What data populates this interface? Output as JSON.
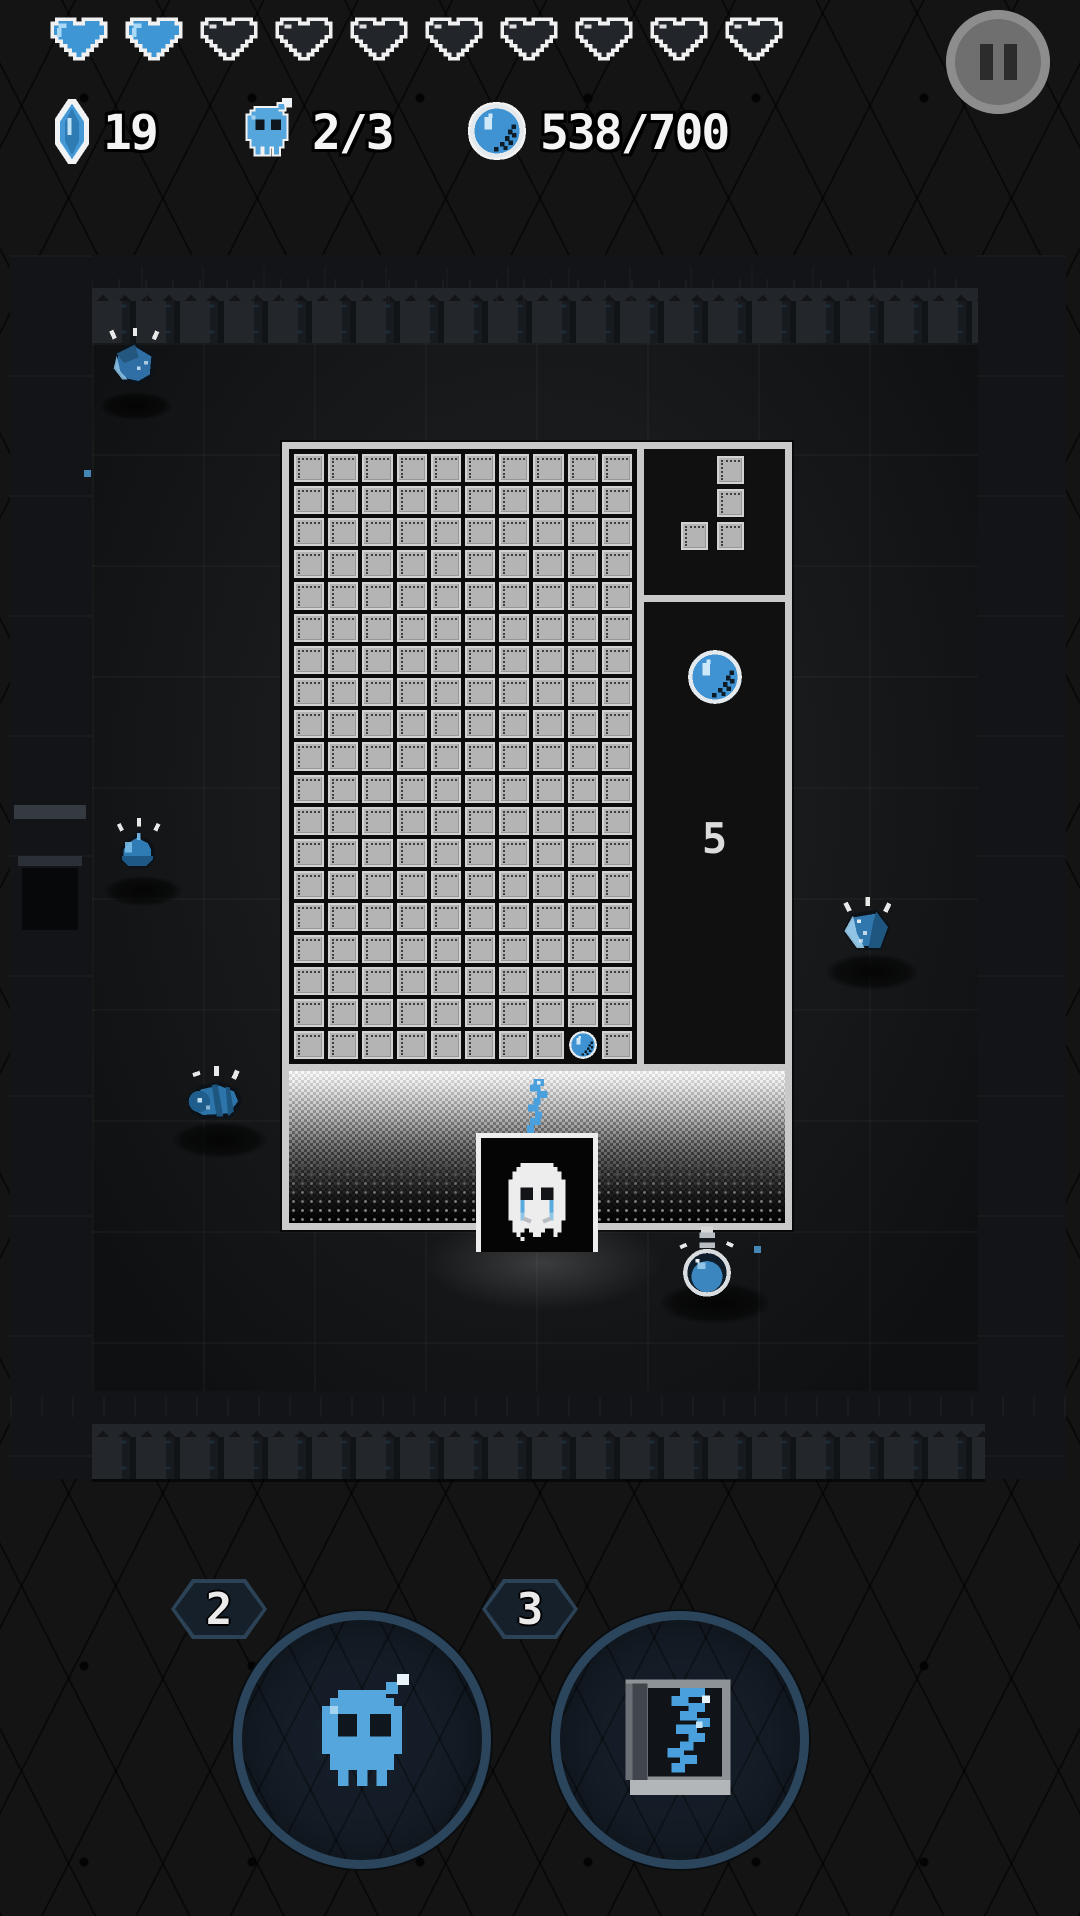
{
  "hud": {
    "hearts": {
      "total": 10,
      "filled": 2,
      "filled_icon": "heart-filled-icon",
      "empty_icon": "heart-empty-icon"
    },
    "counters": [
      {
        "icon": "crystal-icon",
        "value": "19"
      },
      {
        "icon": "skull-bomb-icon",
        "value": "2/3"
      },
      {
        "icon": "orb-icon",
        "value": "538/700"
      }
    ],
    "pause_icon": "pause-icon"
  },
  "board": {
    "grid": {
      "cols": 10,
      "rows": 19,
      "block_icon": "block-tile",
      "ball": {
        "row": 19,
        "col": 9,
        "icon": "orb-icon"
      }
    },
    "preview": {
      "piece": "J-tetromino",
      "cells": [
        [
          1,
          0
        ],
        [
          1,
          1
        ],
        [
          0,
          2
        ],
        [
          1,
          2
        ]
      ]
    },
    "side_panel": {
      "icon": "orb-icon",
      "count": "5"
    },
    "character": {
      "icon": "ghost-character",
      "state": "crying"
    },
    "drop_icon": "soul-squiggle-icon"
  },
  "room": {
    "enemies": [
      {
        "icon": "dice-slime"
      },
      {
        "icon": "drop-slime"
      },
      {
        "icon": "crystal-slime"
      },
      {
        "icon": "shell-snail"
      },
      {
        "icon": "potion-flask"
      }
    ]
  },
  "abilities": [
    {
      "count": "2",
      "icon": "skull-bomb-icon"
    },
    {
      "count": "3",
      "icon": "spell-book-icon"
    }
  ],
  "colors": {
    "accent_blue": "#4aa0dc",
    "hud_text": "#f4f4f4",
    "frame_light": "#c9c9c9",
    "background": "#141414"
  }
}
